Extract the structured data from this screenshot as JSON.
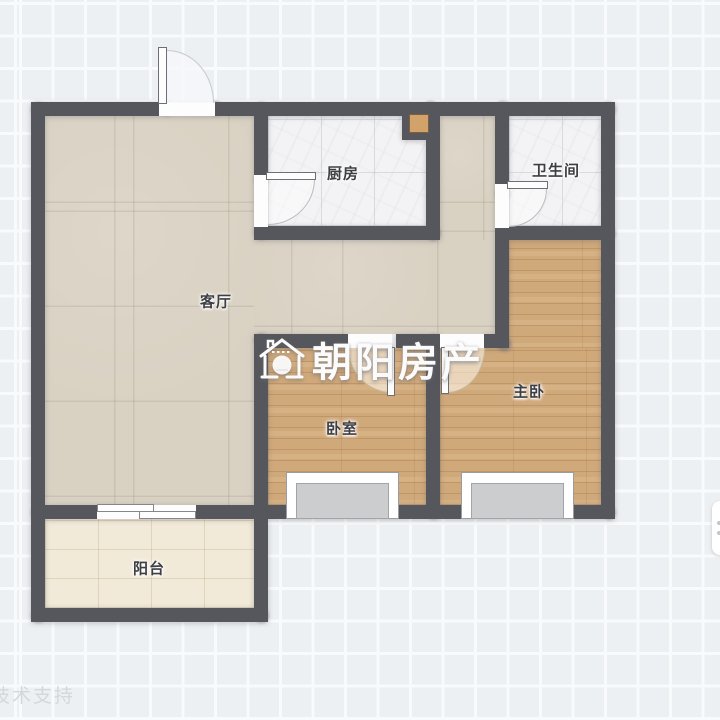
{
  "rooms": {
    "living": {
      "label": "客厅"
    },
    "kitchen": {
      "label": "厨房"
    },
    "bath": {
      "label": "卫生间"
    },
    "master": {
      "label": "主卧"
    },
    "bedroom": {
      "label": "卧室"
    },
    "balcony": {
      "label": "阳台"
    }
  },
  "watermark": {
    "brand": "朝阳房产",
    "logo": "house-badge-icon"
  },
  "footer": {
    "support_text": "技术支持"
  },
  "colors": {
    "wall": "#56575c",
    "grid_background": "#edf0f3",
    "grid_line": "#f8fafb",
    "living_floor": "#d9d1c2",
    "wood_floor": "#d0a97b",
    "marble_floor": "#f3f3f5",
    "balcony_floor": "#f2ead9",
    "flue_fill": "#d2a26b",
    "window_sill": "#cbcdcf",
    "watermark_text": "#fbfbfc"
  }
}
